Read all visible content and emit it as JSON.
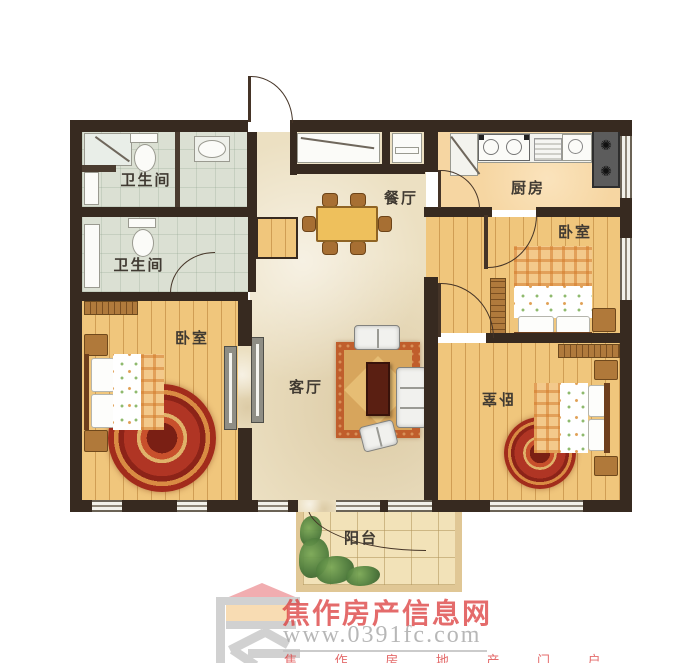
{
  "floorplan": {
    "wall_color": "#372a20",
    "rooms": [
      {
        "id": "bathroom-top",
        "label": "卫生间"
      },
      {
        "id": "bathroom-bottom",
        "label": "卫生间"
      },
      {
        "id": "dining-room",
        "label": "餐厅"
      },
      {
        "id": "kitchen",
        "label": "厨房"
      },
      {
        "id": "bedroom-right-top",
        "label": "卧室"
      },
      {
        "id": "bedroom-left",
        "label": "卧室"
      },
      {
        "id": "living-room",
        "label": "客厅"
      },
      {
        "id": "bedroom-right-bottom",
        "label": "卧室"
      },
      {
        "id": "balcony",
        "label": "阳台"
      }
    ],
    "fridge_fan_icon": "✺"
  },
  "watermark": {
    "site_name": "焦作房产信息网",
    "site_url": "www.0391fc.com",
    "slogan": "焦 作 房 地 产 门 户",
    "name_color": "#dc3e3e",
    "url_color": "#ababab"
  }
}
